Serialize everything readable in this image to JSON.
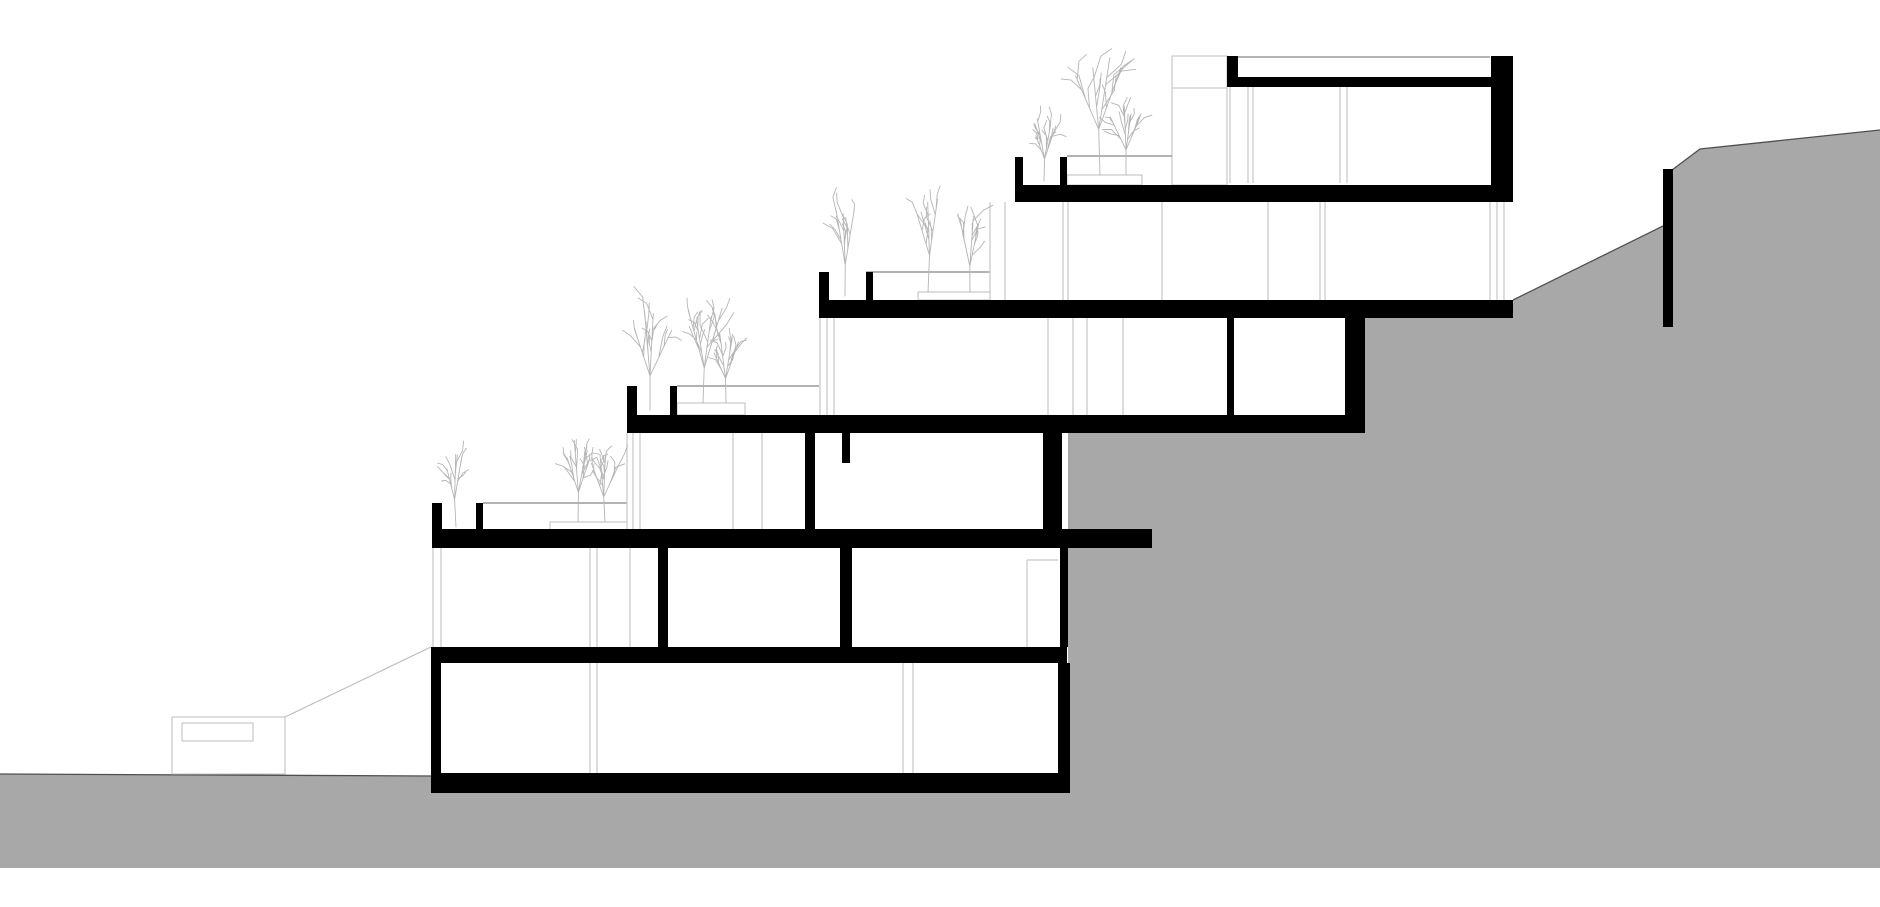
{
  "canvas": {
    "width": 1880,
    "height": 907,
    "background": "#ffffff"
  },
  "palette": {
    "cut": "#000000",
    "terrain": "#a8a8a8",
    "terrain_edge": "#4f4f4f",
    "line_light": "#c6c6c6",
    "line_mid": "#9a9a9a",
    "tree": "#b5b5b5",
    "outline_box": "#bdbdbd"
  },
  "terrain": {
    "polygon": [
      [
        0,
        868
      ],
      [
        0,
        774
      ],
      [
        431,
        776
      ],
      [
        431,
        793
      ],
      [
        1068,
        793
      ],
      [
        1068,
        433
      ],
      [
        1362,
        433
      ],
      [
        1362,
        318
      ],
      [
        1513,
        318
      ],
      [
        1513,
        300
      ],
      [
        1663,
        226
      ],
      [
        1672,
        170
      ],
      [
        1700,
        149
      ],
      [
        1880,
        130
      ],
      [
        1880,
        868
      ]
    ],
    "edge_lines": [
      [
        [
          0,
          774
        ],
        [
          431,
          776
        ]
      ],
      [
        [
          1513,
          300
        ],
        [
          1663,
          226
        ]
      ],
      [
        [
          1672,
          170
        ],
        [
          1700,
          149
        ],
        [
          1880,
          130
        ]
      ]
    ]
  },
  "retaining_wall": [
    1663,
    169,
    10,
    158
  ],
  "slabs": [
    {
      "name": "roof-slab",
      "rect": [
        1227,
        77,
        286,
        10
      ]
    },
    {
      "name": "slab-level-1",
      "rect": [
        1015,
        185,
        498,
        17
      ]
    },
    {
      "name": "slab-level-2",
      "rect": [
        819,
        300,
        694,
        18
      ]
    },
    {
      "name": "slab-level-3",
      "rect": [
        627,
        415,
        738,
        18
      ]
    },
    {
      "name": "slab-level-4",
      "rect": [
        432,
        529,
        720,
        19
      ]
    },
    {
      "name": "slab-level-5",
      "rect": [
        431,
        647,
        636,
        16
      ]
    },
    {
      "name": "foundation-slab",
      "rect": [
        431,
        773,
        639,
        20
      ]
    }
  ],
  "walls": [
    {
      "name": "roof-parapet-stub",
      "rect": [
        1227,
        56,
        11,
        31
      ]
    },
    {
      "name": "upper-unit-right-wall",
      "rect": [
        1491,
        56,
        22,
        146
      ]
    },
    {
      "name": "level2-partition-wall",
      "rect": [
        1227,
        318,
        7,
        97
      ]
    },
    {
      "name": "level2-right-wall",
      "rect": [
        1345,
        318,
        20,
        97
      ]
    },
    {
      "name": "level3-partition-wall",
      "rect": [
        805,
        433,
        10,
        97
      ]
    },
    {
      "name": "level3-beam",
      "rect": [
        842,
        433,
        8,
        30
      ]
    },
    {
      "name": "level3-right-wall",
      "rect": [
        1043,
        433,
        19,
        97
      ]
    },
    {
      "name": "level4-partition-wall-a",
      "rect": [
        658,
        548,
        10,
        99
      ]
    },
    {
      "name": "level4-partition-wall-b",
      "rect": [
        840,
        548,
        12,
        99
      ]
    },
    {
      "name": "level4-right-wall",
      "rect": [
        1060,
        548,
        8,
        99
      ]
    },
    {
      "name": "ground-left-wall",
      "rect": [
        431,
        663,
        10,
        110
      ]
    },
    {
      "name": "ground-right-wall",
      "rect": [
        1058,
        663,
        12,
        110
      ]
    }
  ],
  "planters": [
    {
      "name": "planter-terrace-1",
      "walls": [
        [
          1015,
          157,
          8,
          28
        ],
        [
          1060,
          157,
          7,
          28
        ]
      ]
    },
    {
      "name": "planter-terrace-2",
      "walls": [
        [
          819,
          272,
          10,
          28
        ],
        [
          866,
          272,
          7,
          28
        ]
      ]
    },
    {
      "name": "planter-terrace-3",
      "walls": [
        [
          627,
          386,
          10,
          29
        ],
        [
          670,
          386,
          7,
          29
        ]
      ]
    },
    {
      "name": "planter-terrace-4",
      "walls": [
        [
          432,
          503,
          10,
          27
        ],
        [
          476,
          503,
          7,
          27
        ]
      ]
    }
  ],
  "planting_beds": [
    [
      1067,
      175,
      75,
      10
    ],
    [
      918,
      292,
      72,
      8
    ],
    [
      677,
      403,
      68,
      12
    ],
    [
      550,
      522,
      77,
      8
    ]
  ],
  "railing_lines": [
    [
      1067,
      1172,
      156
    ],
    [
      866,
      990,
      272
    ],
    [
      677,
      819,
      386
    ],
    [
      483,
      627,
      503
    ]
  ],
  "parapet_line": [
    1238,
    1490,
    57
  ],
  "stair_box": {
    "rect": [
      1172,
      56,
      55,
      129
    ],
    "divider_y": 88
  },
  "closet": {
    "vline": [
      1027,
      560,
      87
    ],
    "hline": [
      1027,
      1058,
      560
    ]
  },
  "facade_lines": {
    "story_a": {
      "y": 87,
      "len": 96,
      "xs": [
        1230,
        1248,
        1253,
        1340,
        1347
      ]
    },
    "story_b": {
      "y": 202,
      "len": 98,
      "xs": [
        990,
        1005,
        1063,
        1068,
        1162,
        1268,
        1320,
        1325,
        1490,
        1497,
        1504
      ]
    },
    "story_c": {
      "y": 318,
      "len": 97,
      "xs": [
        820,
        827,
        834,
        1048,
        1073,
        1087,
        1123
      ]
    },
    "story_d": {
      "y": 433,
      "len": 96,
      "xs": [
        627,
        633,
        640,
        733,
        762
      ]
    },
    "story_e": {
      "y": 548,
      "len": 99,
      "xs": [
        433,
        441,
        590,
        597,
        630
      ]
    },
    "story_f": {
      "y": 663,
      "len": 110,
      "xs": [
        590,
        597,
        903,
        913
      ]
    }
  },
  "entrance": {
    "outer": [
      172,
      717,
      113,
      57
    ],
    "inner": [
      182,
      723,
      71,
      18
    ],
    "ramp_line": [
      [
        285,
        717
      ],
      [
        431,
        647
      ]
    ]
  },
  "trees": [
    {
      "x": 456,
      "base": 527,
      "h": 72,
      "seed": 3
    },
    {
      "x": 578,
      "base": 522,
      "h": 78,
      "seed": 5
    },
    {
      "x": 605,
      "base": 522,
      "h": 66,
      "seed": 8
    },
    {
      "x": 650,
      "base": 410,
      "h": 90,
      "seed": 11
    },
    {
      "x": 703,
      "base": 403,
      "h": 92,
      "seed": 14
    },
    {
      "x": 726,
      "base": 403,
      "h": 64,
      "seed": 17
    },
    {
      "x": 845,
      "base": 296,
      "h": 82,
      "seed": 21
    },
    {
      "x": 928,
      "base": 292,
      "h": 96,
      "seed": 24
    },
    {
      "x": 970,
      "base": 292,
      "h": 68,
      "seed": 27
    },
    {
      "x": 1044,
      "base": 181,
      "h": 58,
      "seed": 31
    },
    {
      "x": 1100,
      "base": 175,
      "h": 120,
      "seed": 34
    },
    {
      "x": 1126,
      "base": 175,
      "h": 66,
      "seed": 37
    }
  ]
}
